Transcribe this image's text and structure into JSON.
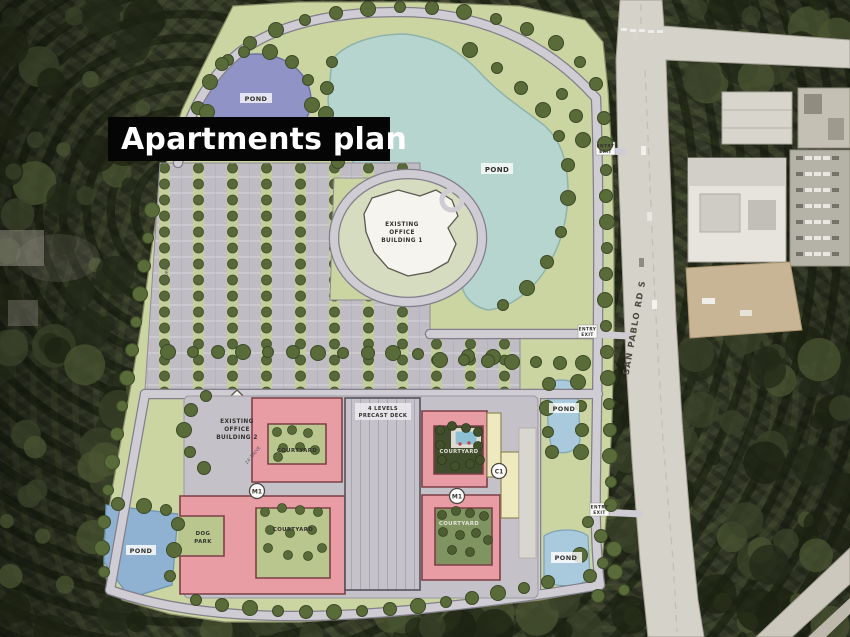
{
  "banner": {
    "title": "Apartments plan"
  },
  "plan": {
    "ponds": {
      "top_left": "POND",
      "central": "POND",
      "east": "POND",
      "south_west": "POND",
      "south_east": "POND"
    },
    "office_building_1": [
      "EXISTING",
      "OFFICE",
      "BUILDING 1"
    ],
    "office_building_2": [
      "EXISTING",
      "OFFICE",
      "BUILDING 2"
    ],
    "parking_deck": [
      "4 LEVELS",
      "PRECAST DECK"
    ],
    "courtyards": {
      "left_upper": "COURTYARD",
      "left_lower": "COURTYARD",
      "right_upper": "COURTYARD",
      "right_lower": "COURTYARD"
    },
    "dog_park": [
      "DOG",
      "PARK"
    ],
    "badges": {
      "m1": "M1",
      "c1": "C1"
    },
    "road_label": "SAN PABLO RD S",
    "entry": [
      "ENTRY",
      "EXIT"
    ],
    "drive_label": "24' DRIVE"
  },
  "colors": {
    "banner_bg": "#050505",
    "banner_text": "#ffffff",
    "apartment_pink": "#e89da5",
    "clubhouse_cream": "#efe9c0",
    "office_white": "#f6f4ee",
    "pond_purple": "#9093c6",
    "pond_teal": "#b7d5cf",
    "pond_blue": "#a9cadd",
    "site_green": "#cbd5a2",
    "asphalt": "#bfbcc4",
    "road_gray": "#d5d2ca",
    "tree_green": "#5a6b3a"
  }
}
